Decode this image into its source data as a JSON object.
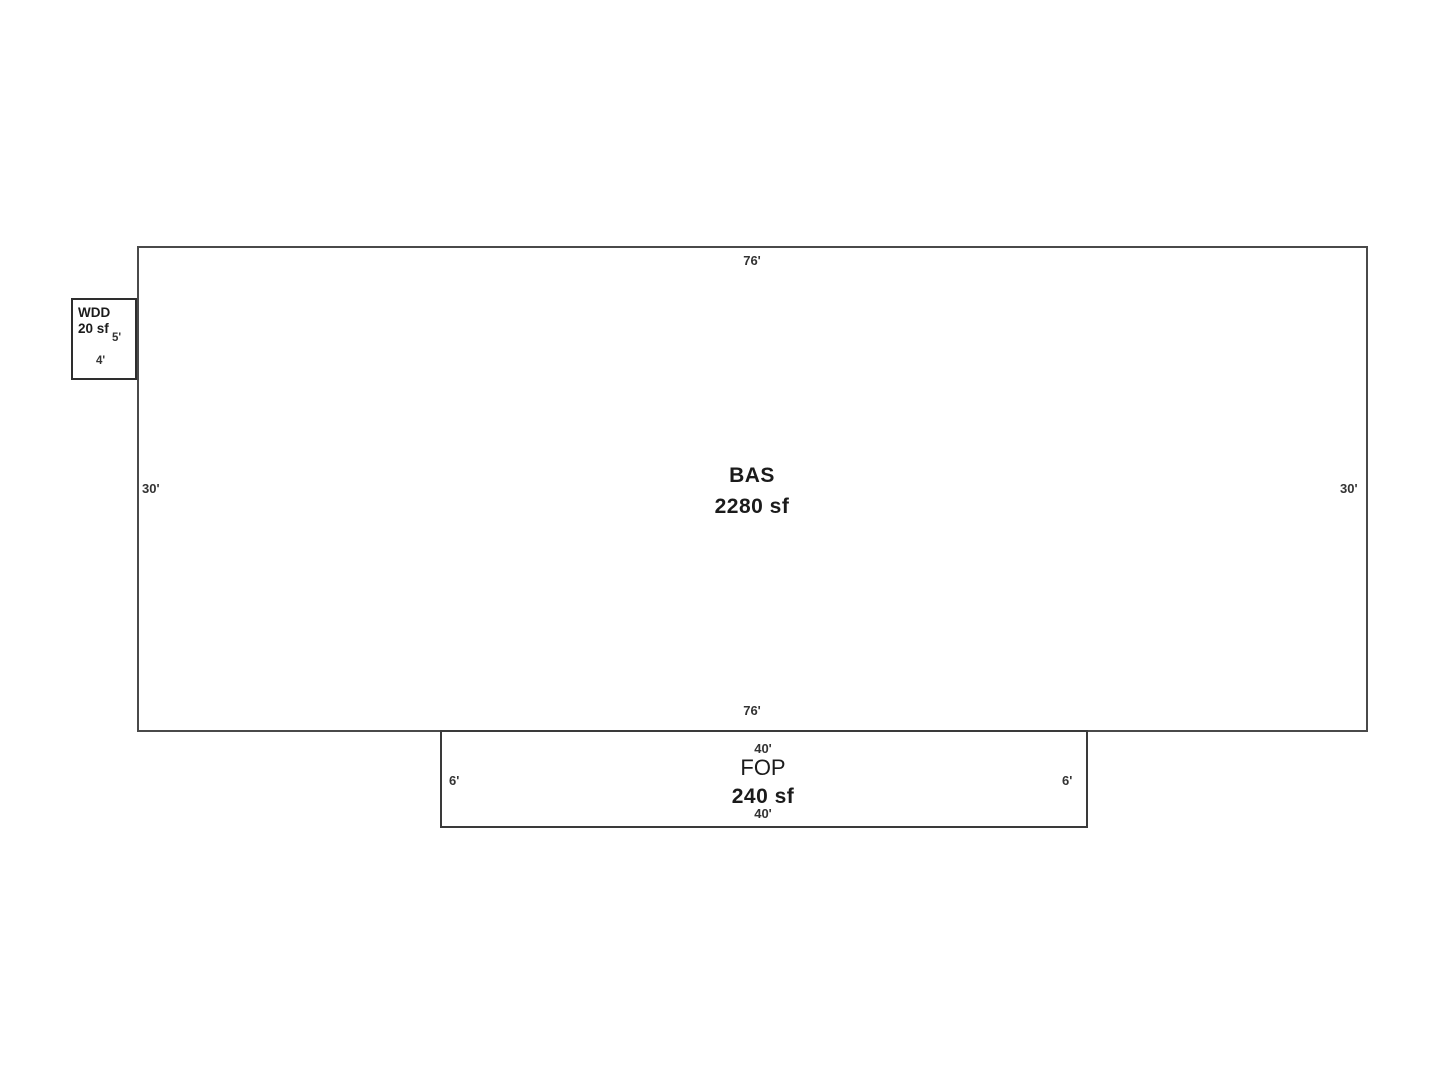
{
  "sketch": {
    "colors": {
      "background": "#ffffff",
      "line": "#4a4a4a",
      "text": "#1b1b1b"
    },
    "bas": {
      "label": "BAS",
      "area": "2280 sf",
      "dim_top": "76'",
      "dim_bottom": "76'",
      "dim_left": "30'",
      "dim_right": "30'"
    },
    "wdd": {
      "label": "WDD",
      "area": "20 sf",
      "dim_right": "5'",
      "dim_bottom": "4'"
    },
    "fop": {
      "label": "FOP",
      "area": "240 sf",
      "dim_top": "40'",
      "dim_bottom": "40'",
      "dim_left": "6'",
      "dim_right": "6'"
    }
  }
}
